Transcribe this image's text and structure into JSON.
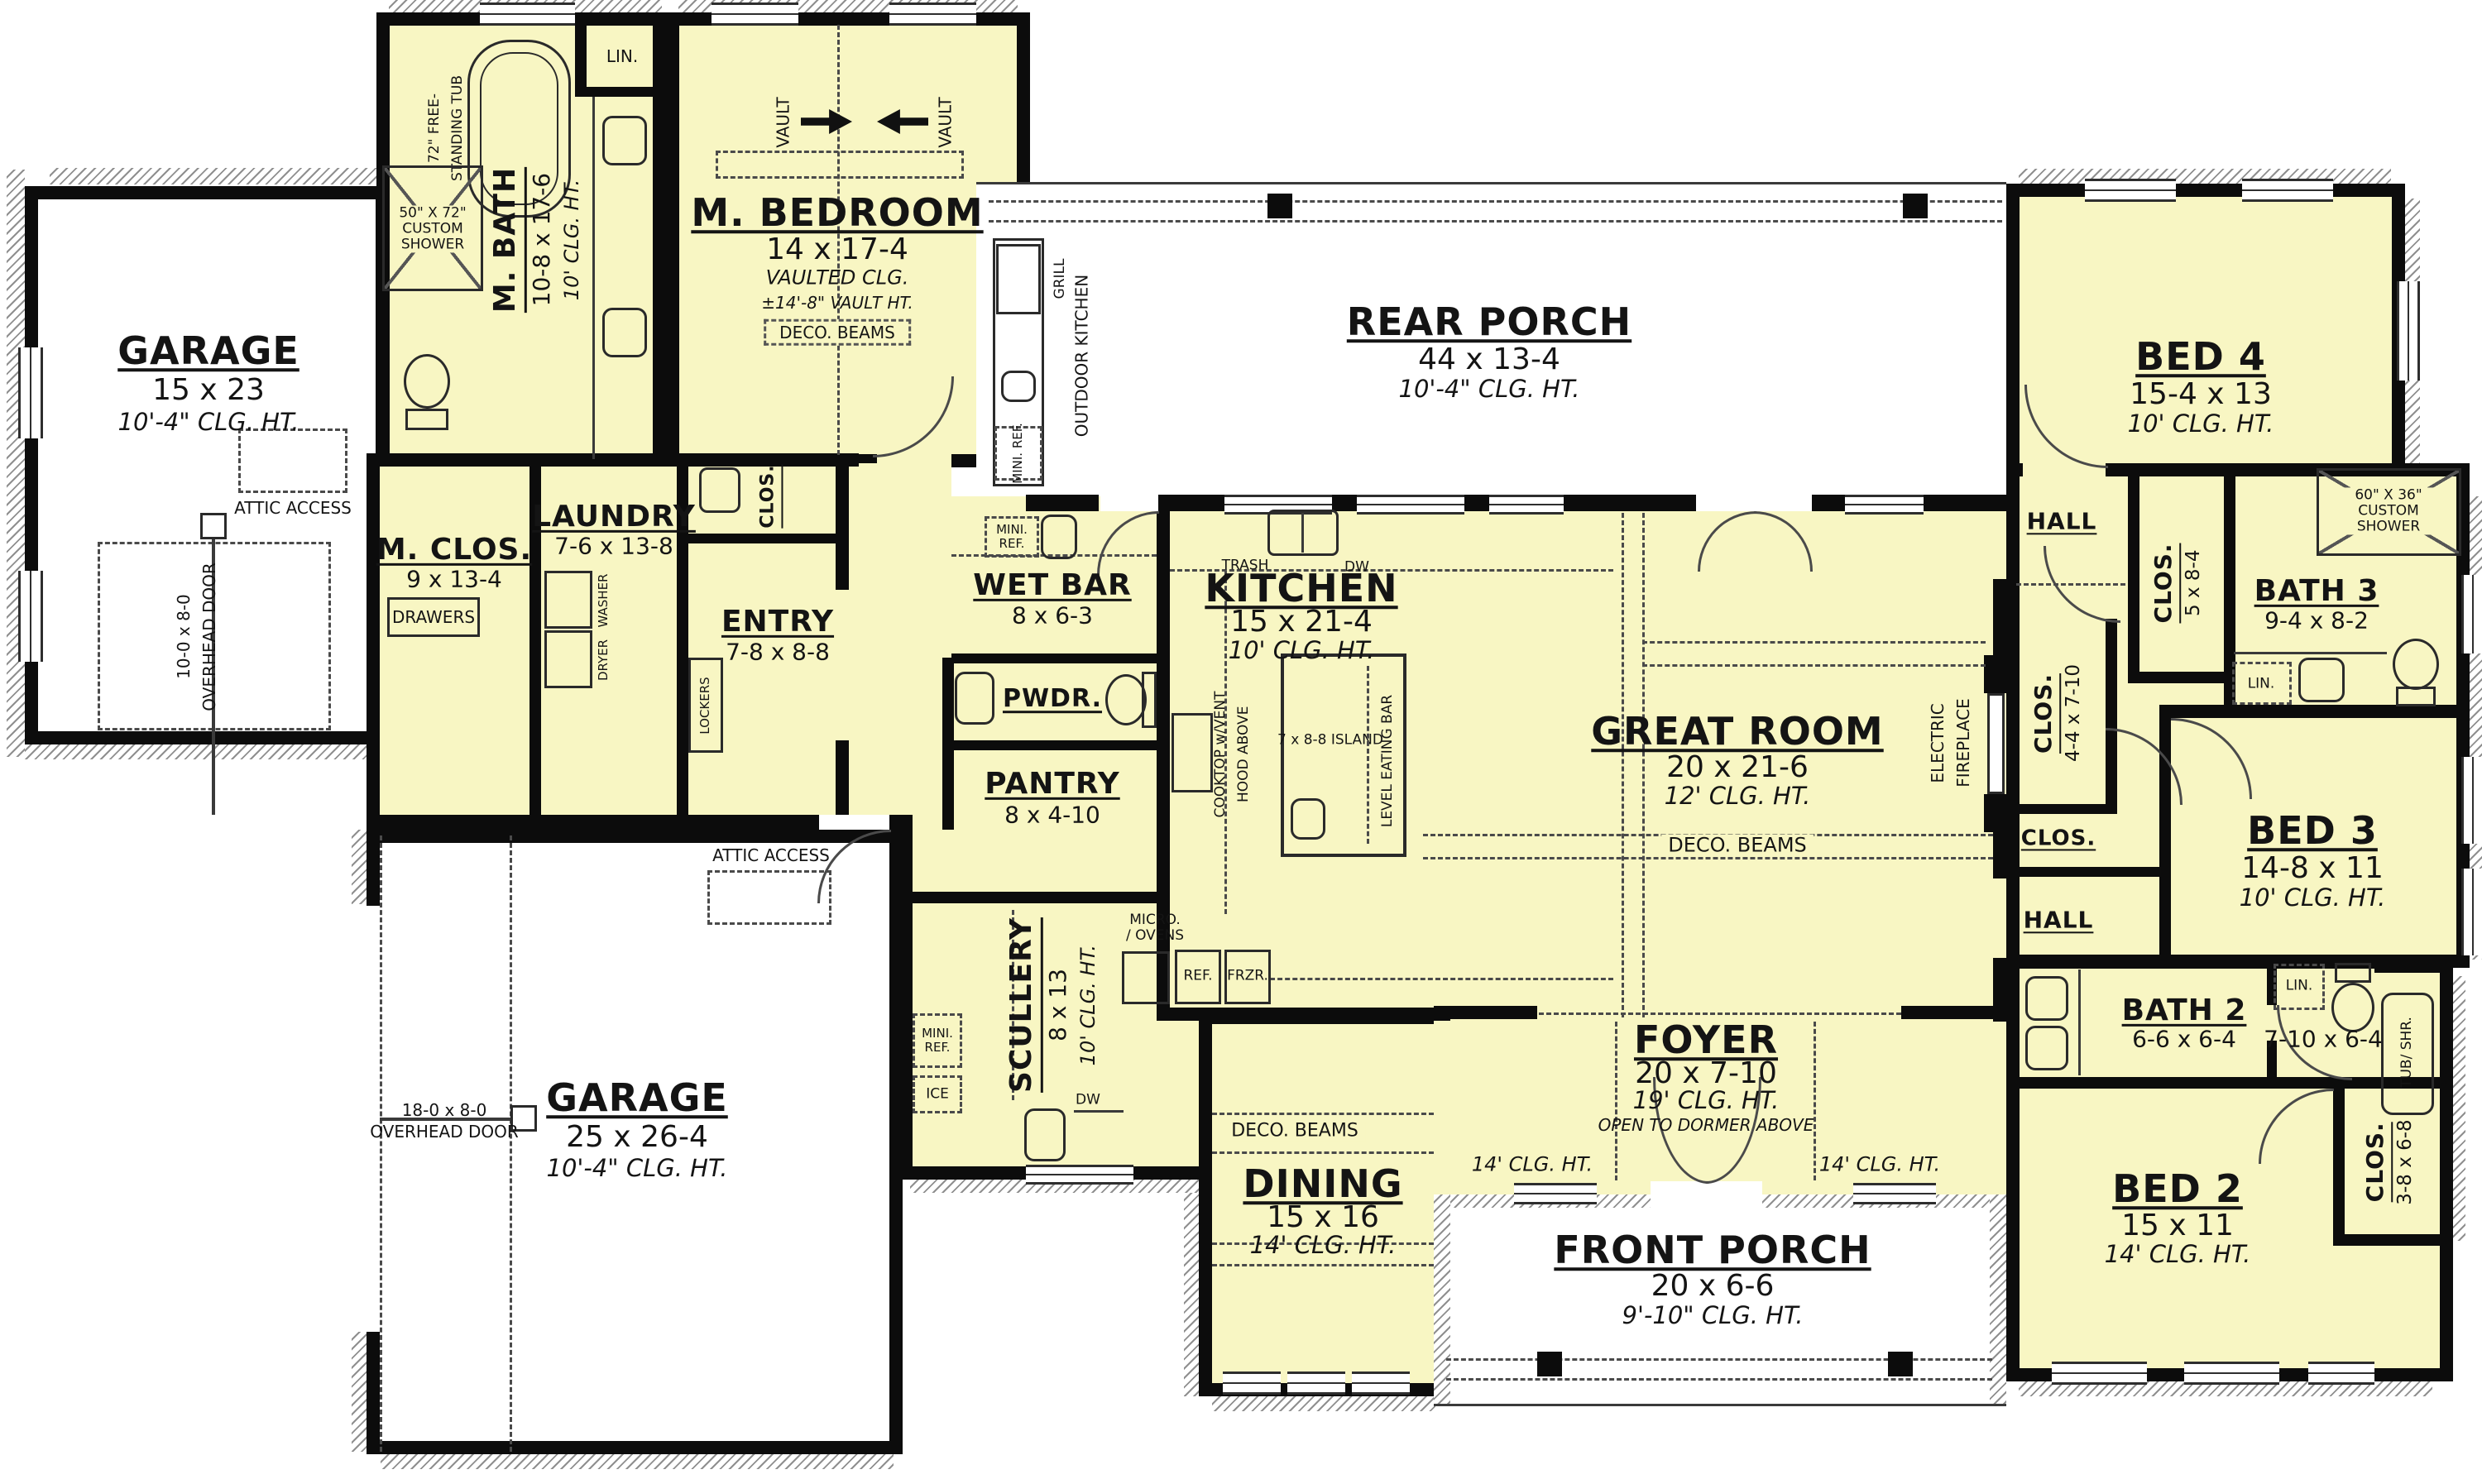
{
  "rooms": {
    "garage1": {
      "name": "GARAGE",
      "dim": "15 x 23",
      "clg": "10'-4\" CLG. HT."
    },
    "garage2": {
      "name": "GARAGE",
      "dim": "25 x 26-4",
      "clg": "10'-4\" CLG. HT."
    },
    "mbath": {
      "name": "M. BATH",
      "dim": "10-8 x 17-6",
      "clg": "10' CLG. HT."
    },
    "mbedroom": {
      "name": "M. BEDROOM",
      "dim": "14 x 17-4",
      "clg": "VAULTED CLG.",
      "vault": "±14'-8\" VAULT HT.",
      "beams": "DECO. BEAMS"
    },
    "mclos": {
      "name": "M. CLOS.",
      "dim": "9 x 13-4"
    },
    "laundry": {
      "name": "LAUNDRY",
      "dim": "7-6 x 13-8"
    },
    "entry": {
      "name": "ENTRY",
      "dim": "7-8 x 8-8"
    },
    "wetbar": {
      "name": "WET BAR",
      "dim": "8 x 6-3"
    },
    "pwdr": {
      "name": "PWDR."
    },
    "pantry": {
      "name": "PANTRY",
      "dim": "8 x 4-10"
    },
    "scullery": {
      "name": "SCULLERY",
      "dim": "8 x 13",
      "clg": "10' CLG. HT."
    },
    "kitchen": {
      "name": "KITCHEN",
      "dim": "15 x 21-4",
      "clg": "10' CLG. HT."
    },
    "greatroom": {
      "name": "GREAT ROOM",
      "dim": "20 x 21-6",
      "clg": "12' CLG. HT.",
      "beams": "DECO. BEAMS"
    },
    "rearporch": {
      "name": "REAR PORCH",
      "dim": "44 x 13-4",
      "clg": "10'-4\" CLG. HT."
    },
    "frontporch": {
      "name": "FRONT PORCH",
      "dim": "20 x 6-6",
      "clg": "9'-10\" CLG. HT."
    },
    "foyer": {
      "name": "FOYER",
      "dim": "20 x 7-10",
      "clg": "19' CLG. HT.",
      "note": "OPEN TO DORMER ABOVE"
    },
    "dining": {
      "name": "DINING",
      "dim": "15 x 16",
      "clg": "14' CLG. HT.",
      "beams": "DECO. BEAMS"
    },
    "bed2": {
      "name": "BED 2",
      "dim": "15 x 11",
      "clg": "14' CLG. HT."
    },
    "bed3": {
      "name": "BED 3",
      "dim": "14-8 x 11",
      "clg": "10' CLG. HT."
    },
    "bed4": {
      "name": "BED 4",
      "dim": "15-4 x 13",
      "clg": "10' CLG. HT."
    },
    "bath2": {
      "name": "BATH 2",
      "dim": "6-6 x 6-4",
      "dim2": "7-10 x 6-4"
    },
    "bath3": {
      "name": "BATH 3",
      "dim": "9-4 x 8-2"
    }
  },
  "closets": {
    "bed4": {
      "name": "CLOS.",
      "dim": "5 x 8-4"
    },
    "hall": {
      "name": "CLOS.",
      "dim": "4-4 x 7-10"
    },
    "small": {
      "name": "CLOS."
    },
    "bed2": {
      "name": "CLOS.",
      "dim": "3-8 x 6-8"
    },
    "entry": {
      "name": "CLOS."
    }
  },
  "halls": {
    "h1": "HALL",
    "h2": "HALL"
  },
  "labels": {
    "lin": "LIN.",
    "drawers": "DRAWERS",
    "lockers": "LOCKERS",
    "washer": "WASHER",
    "dryer": "DRYER",
    "attic": "ATTIC ACCESS",
    "trash": "TRASH",
    "dw": "DW",
    "island": "7 x 8-8 ISLAND",
    "eatingbar": "LEVEL EATING BAR",
    "cooktop1": "COOKTOP w/VENT",
    "cooktop2": "HOOD ABOVE",
    "micro1": "MICRO.",
    "micro2": "/ OVENS",
    "ref": "REF.",
    "frzr": "FRZR.",
    "miniref": "MINI. REF.",
    "ice": "ICE",
    "grill": "GRILL",
    "outdoor": "OUTDOOR KITCHEN",
    "tub1": "72\" FREE-",
    "tub2": "STANDING TUB",
    "mshower": "50\" X 72\" CUSTOM SHOWER",
    "shower3": "60\" X 36\" CUSTOM SHOWER",
    "tubshr": "TUB/ SHR.",
    "fp1": "ELECTRIC",
    "fp2": "FIREPLACE",
    "clg14": "14' CLG. HT.",
    "vault": "VAULT",
    "ohd": "OVERHEAD DOOR",
    "door1": "10-0 x 8-0",
    "door2": "18-0 x 8-0"
  },
  "colors": {
    "room": "#f8f6c3",
    "wall": "#0c0c0c",
    "porch": "#ffffff",
    "line": "#4a4a4a"
  }
}
